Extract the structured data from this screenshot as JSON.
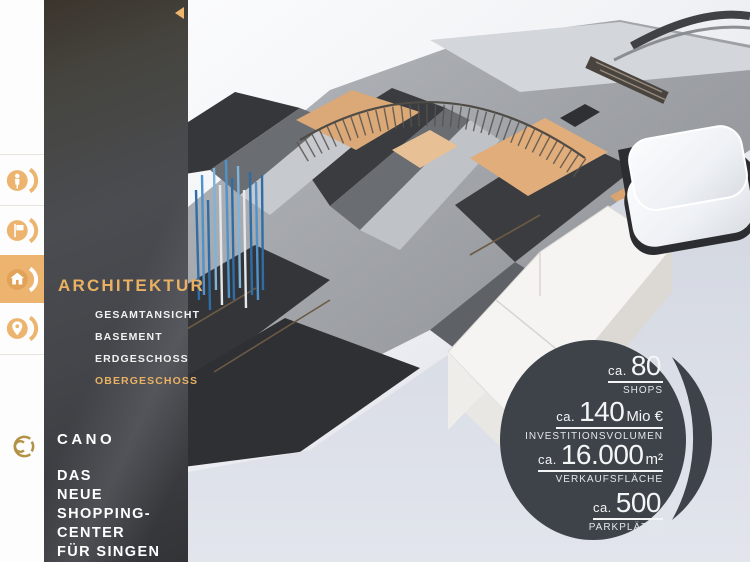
{
  "brand": {
    "name": "CANO",
    "subtitle_lines": [
      "DAS",
      "NEUE",
      "SHOPPING-",
      "CENTER",
      "FÜR SINGEN"
    ]
  },
  "nav_rail": {
    "items": [
      {
        "icon": "visitors-icon",
        "active": false
      },
      {
        "icon": "flag-icon",
        "active": false
      },
      {
        "icon": "architecture-house-icon",
        "active": true
      },
      {
        "icon": "location-pin-icon",
        "active": false
      }
    ]
  },
  "sidebar": {
    "section_title": "ARCHITEKTUR",
    "items": [
      {
        "label": "GESAMTANSICHT",
        "active": false
      },
      {
        "label": "BASEMENT",
        "active": false
      },
      {
        "label": "ERDGESCHOSS",
        "active": false
      },
      {
        "label": "OBERGESCHOSS",
        "active": true
      }
    ]
  },
  "stats_badge": {
    "items": [
      {
        "prefix": "ca.",
        "value": "80",
        "suffix": "",
        "label": "SHOPS"
      },
      {
        "prefix": "ca.",
        "value": "140",
        "suffix": "Mio €",
        "label": "INVESTITIONSVOLUMEN"
      },
      {
        "prefix": "ca.",
        "value": "16.000",
        "suffix": "m²",
        "label": "VERKAUFSFLÄCHE"
      },
      {
        "prefix": "ca.",
        "value": "500",
        "suffix": "",
        "label": "PARKPLÄTZE"
      }
    ]
  },
  "colors": {
    "accent_orange": "#ECB46E",
    "logo_gold": "#B29245",
    "panel_dark": "#3F4145",
    "badge_dark": "#3E4349",
    "floor_tan": "#DBA877",
    "pole_blue": "#3C7FB5"
  }
}
